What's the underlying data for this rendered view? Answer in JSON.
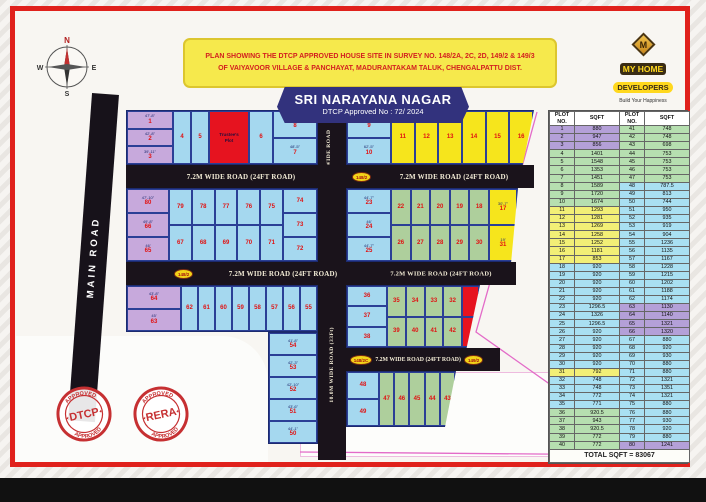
{
  "header": {
    "note_line1": "PLAN SHOWING THE DTCP APPROVED HOUSE SITE IN SURVEY NO. 148/2A, 2C, 2D, 149/2 & 149/3",
    "note_line2": "OF VAIYAVOOR VILLAGE & PANCHAYAT, MADURANTAKAM TALUK, CHENGALPATTU DIST.",
    "title": "SRI NARAYANA NAGAR",
    "subtitle": "DTCP Approved No : 72/ 2024"
  },
  "logo": {
    "mark": "M",
    "name1": "MY HOME",
    "name2": "DEVELOPERS",
    "tagline": "Build Your Happiness"
  },
  "compass": {
    "n": "N",
    "e": "E",
    "s": "S",
    "w": "W"
  },
  "roads": {
    "main_road": "MAIN ROAD",
    "road_72": "7.2M WIDE ROAD (24FT ROAD)",
    "road_10": "10.0M WIDE ROAD (33Ft)",
    "survey_ovals": {
      "o1": "148/2",
      "o2": "148/2",
      "o3": "148/2C",
      "o4": "149/2"
    }
  },
  "special": {
    "trustee_line1": "Trustee's",
    "trustee_line2": "Plot",
    "park": "Park"
  },
  "stamps": {
    "dtcp": {
      "center": "DTCP",
      "top": "APPROVED",
      "bottom": "APPROVED"
    },
    "rera": {
      "center": "RERA",
      "top": "APPROVED",
      "bottom": "APPROVED"
    }
  },
  "plan": {
    "blockA": {
      "left": [
        {
          "n": "1",
          "d": "47'-8\""
        },
        {
          "n": "2",
          "d": "42'-8\""
        },
        {
          "n": "3",
          "d": "39'-11\""
        }
      ],
      "mid": [
        {
          "n": "4"
        },
        {
          "n": "5"
        }
      ],
      "mid2": [
        {
          "n": "6"
        }
      ],
      "right": [
        {
          "n": "8",
          "d": "50'-2\""
        },
        {
          "n": "7",
          "d": "48'-5\""
        }
      ]
    },
    "blockB": {
      "left": [
        {
          "n": "9",
          "d": "27'-4\""
        },
        {
          "n": "10",
          "d": "62'-5\""
        }
      ],
      "main": [
        {
          "n": "11"
        },
        {
          "n": "12"
        },
        {
          "n": "13"
        },
        {
          "n": "14"
        },
        {
          "n": "15"
        },
        {
          "n": "16"
        }
      ]
    },
    "blockC": {
      "left": [
        {
          "n": "80",
          "d": "47'-10\""
        },
        {
          "n": "66",
          "d": "49'-8\""
        },
        {
          "n": "65",
          "d": "46'"
        }
      ],
      "top": [
        {
          "n": "79"
        },
        {
          "n": "78"
        },
        {
          "n": "77"
        },
        {
          "n": "76"
        },
        {
          "n": "75"
        }
      ],
      "bottom": [
        {
          "n": "67"
        },
        {
          "n": "68"
        },
        {
          "n": "69"
        },
        {
          "n": "70"
        },
        {
          "n": "71"
        }
      ],
      "right": [
        {
          "n": "74"
        },
        {
          "n": "73"
        },
        {
          "n": "72"
        }
      ]
    },
    "blockD": {
      "left": [
        {
          "n": "23",
          "d": "44'-7\""
        },
        {
          "n": "24",
          "d": "46'"
        },
        {
          "n": "25",
          "d": "44'-7\""
        }
      ],
      "top": [
        {
          "n": "22"
        },
        {
          "n": "21"
        },
        {
          "n": "20"
        },
        {
          "n": "19"
        },
        {
          "n": "18"
        }
      ],
      "bottom": [
        {
          "n": "26"
        },
        {
          "n": "27"
        },
        {
          "n": "28"
        },
        {
          "n": "29"
        },
        {
          "n": "30"
        }
      ],
      "right": [
        {
          "n": "17",
          "c": "y",
          "d": "30'-7\""
        },
        {
          "n": "31",
          "c": "y",
          "d": "19'"
        }
      ]
    },
    "blockE": {
      "left": [
        {
          "n": "64",
          "d": "43'-8\""
        },
        {
          "n": "63",
          "d": "45'"
        }
      ],
      "top": [
        {
          "n": "62"
        },
        {
          "n": "61"
        },
        {
          "n": "60"
        },
        {
          "n": "59"
        },
        {
          "n": "58"
        },
        {
          "n": "57"
        },
        {
          "n": "56"
        },
        {
          "n": "55"
        }
      ],
      "col": [
        {
          "n": "54",
          "d": "41'-8\""
        },
        {
          "n": "53",
          "d": "42'-3\""
        },
        {
          "n": "52",
          "d": "42'-10\""
        },
        {
          "n": "51",
          "d": "43'-6\""
        },
        {
          "n": "50",
          "d": "44'-1\""
        }
      ]
    },
    "blockG": {
      "left": [
        {
          "n": "36"
        },
        {
          "n": "37"
        },
        {
          "n": "38"
        }
      ],
      "top": [
        {
          "n": "35"
        },
        {
          "n": "34"
        },
        {
          "n": "33"
        },
        {
          "n": "32"
        }
      ],
      "bottom": [
        {
          "n": "39"
        },
        {
          "n": "40"
        },
        {
          "n": "41"
        },
        {
          "n": "42"
        }
      ],
      "red": [
        {
          "n": ""
        },
        {
          "n": ""
        }
      ]
    },
    "blockF": {
      "left": [
        {
          "n": "48"
        },
        {
          "n": "49"
        }
      ],
      "main": [
        {
          "n": "47"
        },
        {
          "n": "46"
        },
        {
          "n": "45"
        },
        {
          "n": "44"
        },
        {
          "n": "43"
        }
      ]
    }
  },
  "table": {
    "headers": [
      "PLOT NO.",
      "SQFT",
      "PLOT NO.",
      "SQFT"
    ],
    "left": [
      [
        "1",
        "880",
        "p"
      ],
      [
        "2",
        "947",
        "p"
      ],
      [
        "3",
        "856",
        "p"
      ],
      [
        "4",
        "1401",
        "g"
      ],
      [
        "5",
        "1548",
        "g"
      ],
      [
        "6",
        "1353",
        "g"
      ],
      [
        "7",
        "1451",
        "g"
      ],
      [
        "8",
        "1589",
        "g"
      ],
      [
        "9",
        "1720",
        "g"
      ],
      [
        "10",
        "1674",
        "g"
      ],
      [
        "11",
        "1293",
        "y"
      ],
      [
        "12",
        "1281",
        "y"
      ],
      [
        "13",
        "1269",
        "y"
      ],
      [
        "14",
        "1258",
        "y"
      ],
      [
        "15",
        "1252",
        "y"
      ],
      [
        "16",
        "1181",
        "y"
      ],
      [
        "17",
        "853",
        "y"
      ],
      [
        "18",
        "920",
        "c"
      ],
      [
        "19",
        "920",
        "c"
      ],
      [
        "20",
        "920",
        "c"
      ],
      [
        "21",
        "920",
        "c"
      ],
      [
        "22",
        "920",
        "c"
      ],
      [
        "23",
        "1296.5",
        "c"
      ],
      [
        "24",
        "1326",
        "c"
      ],
      [
        "25",
        "1296.5",
        "c"
      ],
      [
        "26",
        "920",
        "c"
      ],
      [
        "27",
        "920",
        "c"
      ],
      [
        "28",
        "920",
        "c"
      ],
      [
        "29",
        "920",
        "c"
      ],
      [
        "30",
        "920",
        "c"
      ],
      [
        "31",
        "792",
        "y"
      ],
      [
        "32",
        "748",
        "c"
      ],
      [
        "33",
        "748",
        "c"
      ],
      [
        "34",
        "772",
        "c"
      ],
      [
        "35",
        "771",
        "c"
      ],
      [
        "36",
        "920.5",
        "g"
      ],
      [
        "37",
        "943",
        "g"
      ],
      [
        "38",
        "920.5",
        "g"
      ],
      [
        "39",
        "772",
        "g"
      ],
      [
        "40",
        "772",
        "g"
      ]
    ],
    "right": [
      [
        "41",
        "748",
        "g"
      ],
      [
        "42",
        "748",
        "g"
      ],
      [
        "43",
        "698",
        "g"
      ],
      [
        "44",
        "753",
        "g"
      ],
      [
        "45",
        "753",
        "g"
      ],
      [
        "46",
        "753",
        "g"
      ],
      [
        "47",
        "753",
        "g"
      ],
      [
        "48",
        "787.5",
        "c"
      ],
      [
        "49",
        "813",
        "c"
      ],
      [
        "50",
        "744",
        "c"
      ],
      [
        "51",
        "950",
        "c"
      ],
      [
        "52",
        "935",
        "c"
      ],
      [
        "53",
        "919",
        "c"
      ],
      [
        "54",
        "904",
        "c"
      ],
      [
        "55",
        "1236",
        "c"
      ],
      [
        "56",
        "1135",
        "c"
      ],
      [
        "57",
        "1167",
        "c"
      ],
      [
        "58",
        "1228",
        "c"
      ],
      [
        "59",
        "1215",
        "c"
      ],
      [
        "60",
        "1202",
        "c"
      ],
      [
        "61",
        "1188",
        "c"
      ],
      [
        "62",
        "1174",
        "c"
      ],
      [
        "63",
        "1130",
        "p"
      ],
      [
        "64",
        "1140",
        "p"
      ],
      [
        "65",
        "1321",
        "p"
      ],
      [
        "66",
        "1320",
        "p"
      ],
      [
        "67",
        "880",
        "c"
      ],
      [
        "68",
        "920",
        "c"
      ],
      [
        "69",
        "930",
        "c"
      ],
      [
        "70",
        "880",
        "c"
      ],
      [
        "71",
        "880",
        "c"
      ],
      [
        "72",
        "1321",
        "c"
      ],
      [
        "73",
        "1351",
        "c"
      ],
      [
        "74",
        "1321",
        "c"
      ],
      [
        "75",
        "880",
        "c"
      ],
      [
        "76",
        "880",
        "c"
      ],
      [
        "77",
        "930",
        "c"
      ],
      [
        "78",
        "920",
        "c"
      ],
      [
        "79",
        "880",
        "c"
      ],
      [
        "80",
        "1241",
        "p"
      ]
    ],
    "total": "TOTAL SQFT = 83067"
  },
  "colors": {
    "frame_red": "#e0211c",
    "road_black": "#1a131b",
    "banner_navy": "#32327d",
    "note_yellow": "#f6e94c",
    "plot_purple": "#c7a9dc",
    "plot_blue": "#a5d8ef",
    "plot_yellow": "#f6e51c",
    "plot_green": "#aecf9c",
    "plot_red": "#e6131f",
    "stamp_red": "#c63032",
    "number_red": "#e01212"
  }
}
